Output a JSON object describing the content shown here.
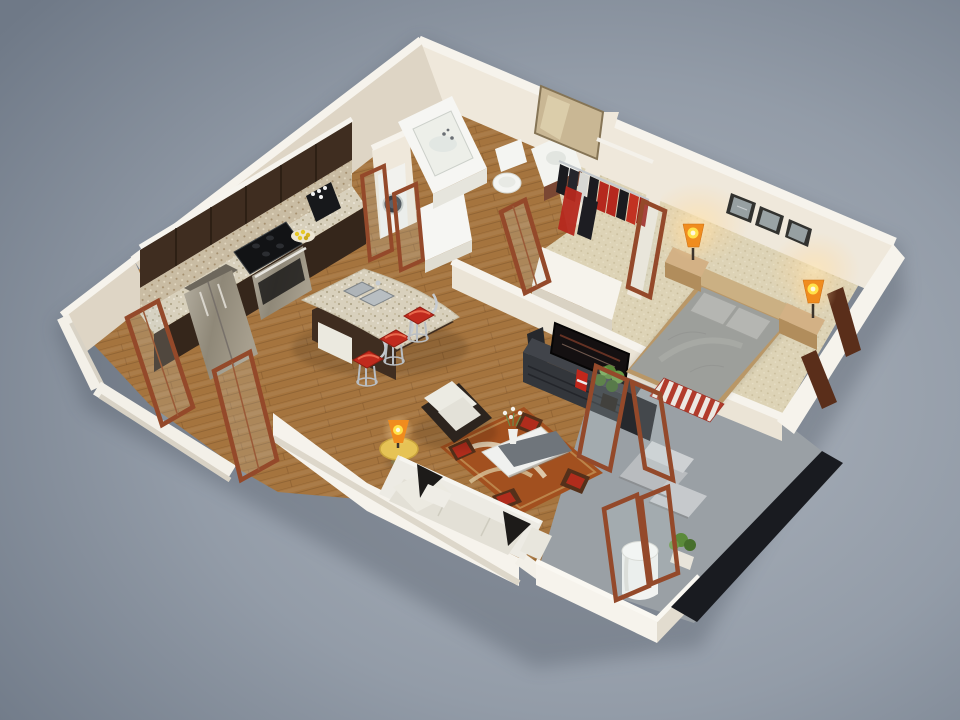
{
  "scene": {
    "description": "3D isometric cutaway render of a one-bedroom apartment floor plan on a gray studio background",
    "rooms": [
      {
        "name": "kitchen",
        "floor": "wood",
        "furniture": [
          "upper-cabinets",
          "refrigerator",
          "cooktop",
          "oven",
          "coffee-maker",
          "fruit-plate",
          "island-with-sink",
          "bar-stools"
        ]
      },
      {
        "name": "bathroom",
        "floor": "wood",
        "furniture": [
          "bathtub",
          "washing-machine",
          "toilet",
          "sink-vanity",
          "leaning-mirror"
        ]
      },
      {
        "name": "walk-in-closet",
        "floor": "carpet",
        "furniture": [
          "clothes-rail",
          "hanging-clothes",
          "shelf"
        ]
      },
      {
        "name": "bedroom",
        "floor": "carpet",
        "furniture": [
          "double-bed",
          "nightstands",
          "table-lamps",
          "framed-pictures"
        ]
      },
      {
        "name": "living-room",
        "floor": "wood",
        "furniture": [
          "sofa",
          "armchair",
          "coffee-table",
          "area-rug",
          "tv",
          "media-console",
          "speaker",
          "subwoofer",
          "plant",
          "round-side-table",
          "table-lamp"
        ]
      },
      {
        "name": "balcony",
        "floor": "concrete",
        "furniture": [
          "chaise-lounge",
          "water-tank",
          "plant",
          "glass-railing"
        ]
      }
    ],
    "counts": {
      "bar_stools": 3,
      "framed_pictures": 3,
      "glowing_lamps": 3,
      "open_door_frames": 8
    }
  },
  "colors": {
    "bg_center": "#adb4bd",
    "bg_mid": "#939ca8",
    "bg_edge": "#6f7987",
    "wall_top": "#f6f3ec",
    "wall_lit": "#efe8db",
    "wall_mid": "#ebe4d6",
    "wall_shadow": "#ded5c5",
    "floor_wood": "#a5743e",
    "carpet": "#ddd3b6",
    "concrete": "#9aa0a5",
    "railing_dark": "#191b20",
    "cabinet_dark": "#3f2d20",
    "backsplash": "#c9bca3",
    "granite": "#d8d0bc",
    "stainless": "#a9a396",
    "black": "#121315",
    "tv_screen": "#141011",
    "media_dark": "#33363b",
    "media_darker": "#26282c",
    "stool_red": "#c02a1d",
    "rug_base": "#a2501f",
    "sofa_white": "#edebe4",
    "pillow_black": "#1d1b19",
    "bed_duvet": "#9d9f9b",
    "bed_headboard": "#cbb083",
    "nightstand": "#d3b185",
    "lamp_orange": "#f08c1e",
    "lamp_core": "#ffe14a",
    "chaise_gray": "#b9bcbf",
    "tank_white": "#f2f3f1",
    "mirror_tan": "#c9b794",
    "door_wood": "#94492a",
    "tub_white": "#f6f6f3",
    "table_yellow": "#e6c355",
    "clothes_red": "#b5281e",
    "plant_green": "#5b8a3a"
  }
}
